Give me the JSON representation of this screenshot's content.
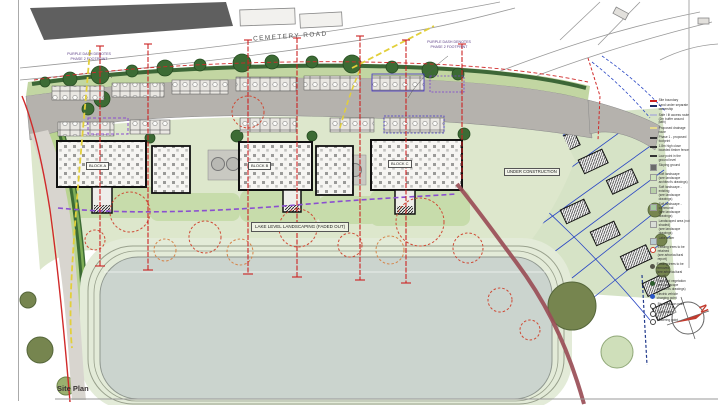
{
  "sheet": {
    "title": "Site Plan"
  },
  "map": {
    "road_label": "CEMETERY ROAD",
    "annotations": {
      "phase2_left": "PURPLE DASH DENOTES\nPHASE 2 FOOTPRINT",
      "phase2_right": "PURPLE DASH DENOTES\nPHASE 2 FOOTPRINT",
      "under_construction": "UNDER CONSTRUCTION",
      "lake_label": "LAKE LEVEL LANDSCAPING (FADED OUT)"
    },
    "blocks": [
      {
        "label": "BLOCK A"
      },
      {
        "label": "BLOCK B"
      },
      {
        "label": "BLOCK C"
      }
    ],
    "compass_label": "N"
  },
  "legend": {
    "items": [
      {
        "label": "Site boundary",
        "color": "#cc2020"
      },
      {
        "label": "Land under separate ownership",
        "color": "#1c2a66"
      },
      {
        "label": "Safe / lit access route\n(2m buffer around path)",
        "color": "#b8bed2"
      },
      {
        "label": "Proposed drainage route",
        "color": "#e6da8e"
      },
      {
        "label": "Phase 1 - proposed footprint",
        "color": "#333333"
      },
      {
        "label": "1.8m high close boarded timber fence",
        "color": "#333333"
      },
      {
        "label": "Low point in the ground level",
        "color": "#333333"
      },
      {
        "label": "Sloping ground",
        "color": "#6b6b6b"
      },
      {
        "label": "Soft landscape\n(see landscape architect's drawings)",
        "color": "#cfe3bc"
      },
      {
        "label": "Soft landscape - existing\n(see landscape drawings)",
        "color": "#b8d0a8"
      },
      {
        "label": "Soft landscape - communal\n(see landscape drawings)",
        "color": "#a4c79e"
      },
      {
        "label": "Landscaped area (not shaded)\n(see landscape drawings)",
        "color": "#d9ded7"
      },
      {
        "label": "Lake water",
        "color": "#b9cbd2"
      },
      {
        "label": "Existing trees to be retained\n(see arboricultural report)",
        "color": "#cc3a28"
      },
      {
        "label": "Existing trees to be removed\n(see arboricultural report)",
        "color": "#56564a"
      },
      {
        "label": "Proposed vegetation\n(see landscape architect's drawings)",
        "color": "#2e5c2e"
      },
      {
        "label": "Electric vehicle charging point",
        "color": "#2b57c8"
      },
      {
        "label": "Bin collection point",
        "color": "#444444"
      },
      {
        "label": "Cycle store",
        "color": "#444444"
      },
      {
        "label": "Watering point",
        "color": "#444444"
      }
    ]
  },
  "colors": {
    "road": "#b5b2ad",
    "lawn": "#dde7cc",
    "lake": "#cbd4ce",
    "hedge": "#2f5b2b",
    "boundary_red": "#d02a2a",
    "phase2_purple": "#8a4fd0",
    "construction_blue": "#2a47c4",
    "maroon_edge": "#9a4e57",
    "drainage_yellow": "#e2cf3a"
  }
}
